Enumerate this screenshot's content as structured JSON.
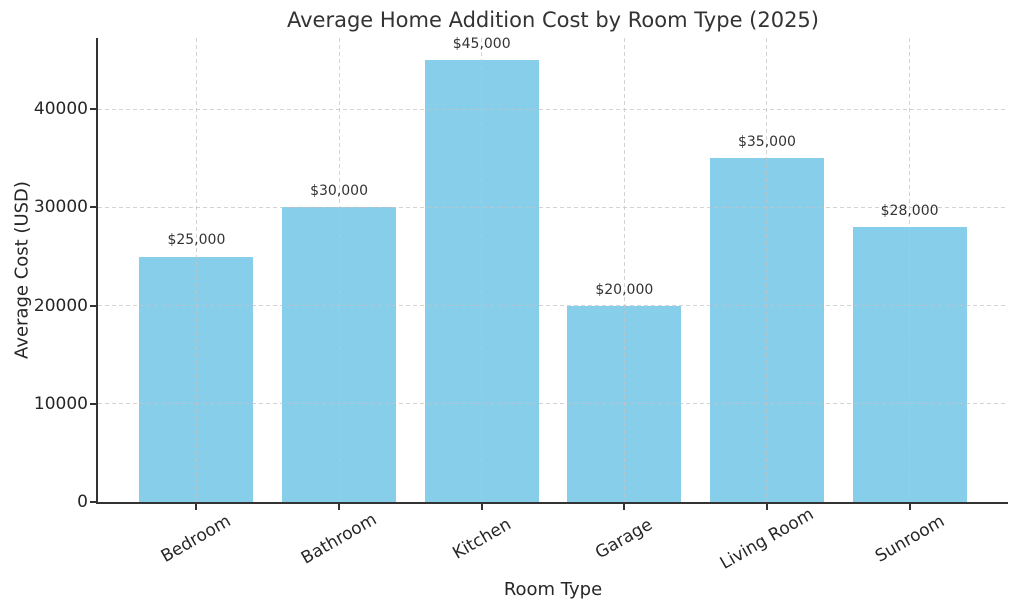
{
  "chart_data": {
    "type": "bar",
    "title": "Average Home Addition Cost by Room Type (2025)",
    "xlabel": "Room Type",
    "ylabel": "Average Cost (USD)",
    "categories": [
      "Bedroom",
      "Bathroom",
      "Kitchen",
      "Garage",
      "Living Room",
      "Sunroom"
    ],
    "values": [
      25000,
      30000,
      45000,
      20000,
      35000,
      28000
    ],
    "data_labels": [
      "$25,000",
      "$30,000",
      "$45,000",
      "$20,000",
      "$35,000",
      "$28,000"
    ],
    "yticks": [
      0,
      10000,
      20000,
      30000,
      40000
    ],
    "ytick_labels": [
      "0",
      "10000",
      "20000",
      "30000",
      "40000"
    ],
    "ylim": [
      0,
      47250
    ],
    "bar_color": "#87ceeb",
    "bar_width_frac": 0.8,
    "grid": "dashed, both axes, drawn over bars",
    "legend": "none",
    "x_tick_rotation_deg": 30
  }
}
